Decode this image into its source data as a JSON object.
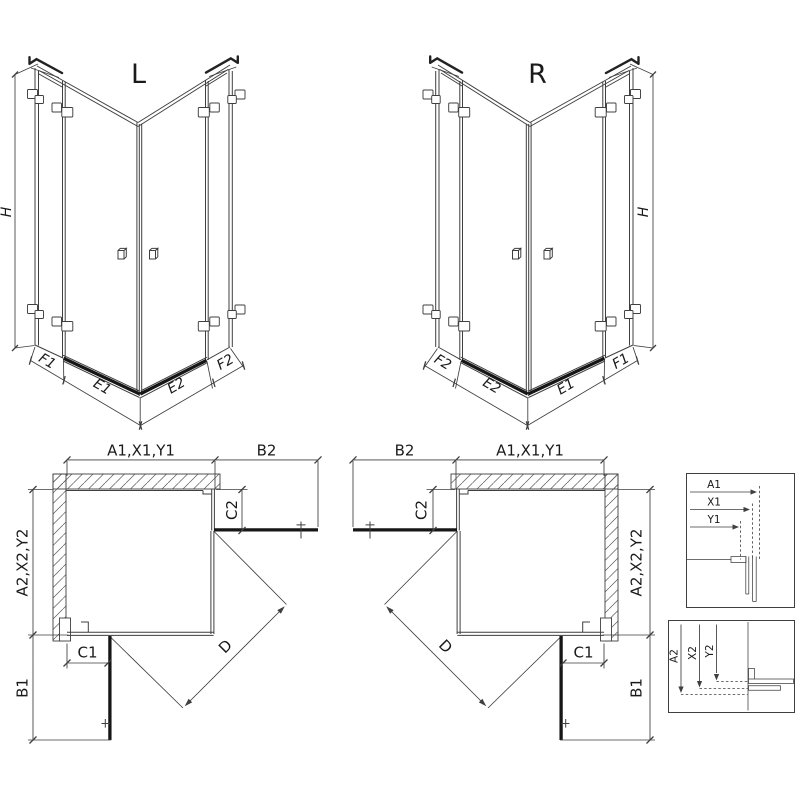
{
  "drawing": {
    "iso_left": {
      "view_label": "L",
      "height_dim": "H",
      "dims": {
        "f1": "F1",
        "e1": "E1",
        "e2": "E2",
        "f2": "F2"
      }
    },
    "iso_right": {
      "view_label": "R",
      "height_dim": "H",
      "dims": {
        "f1": "F1",
        "e1": "E1",
        "e2": "E2",
        "f2": "F2"
      }
    },
    "plan_left": {
      "width_dim": "A1,X1,Y1",
      "door_width_dim": "B2",
      "side_panel_top_dim": "C2",
      "depth_dim": "A2,X2,Y2",
      "side_panel_bottom_dim": "C1",
      "door_depth_dim": "B1",
      "diagonal_dim": "D"
    },
    "plan_right": {
      "width_dim": "A1,X1,Y1",
      "door_width_dim": "B2",
      "side_panel_top_dim": "C2",
      "depth_dim": "A2,X2,Y2",
      "side_panel_bottom_dim": "C1",
      "door_depth_dim": "B1",
      "diagonal_dim": "D"
    },
    "detail_widths": {
      "a1": "A1",
      "x1": "X1",
      "y1": "Y1"
    },
    "detail_depths": {
      "a2": "A2",
      "x2": "X2",
      "y2": "Y2"
    },
    "colors": {
      "line": "#3f3f3f",
      "dark": "#161616",
      "background": "#ffffff"
    }
  }
}
